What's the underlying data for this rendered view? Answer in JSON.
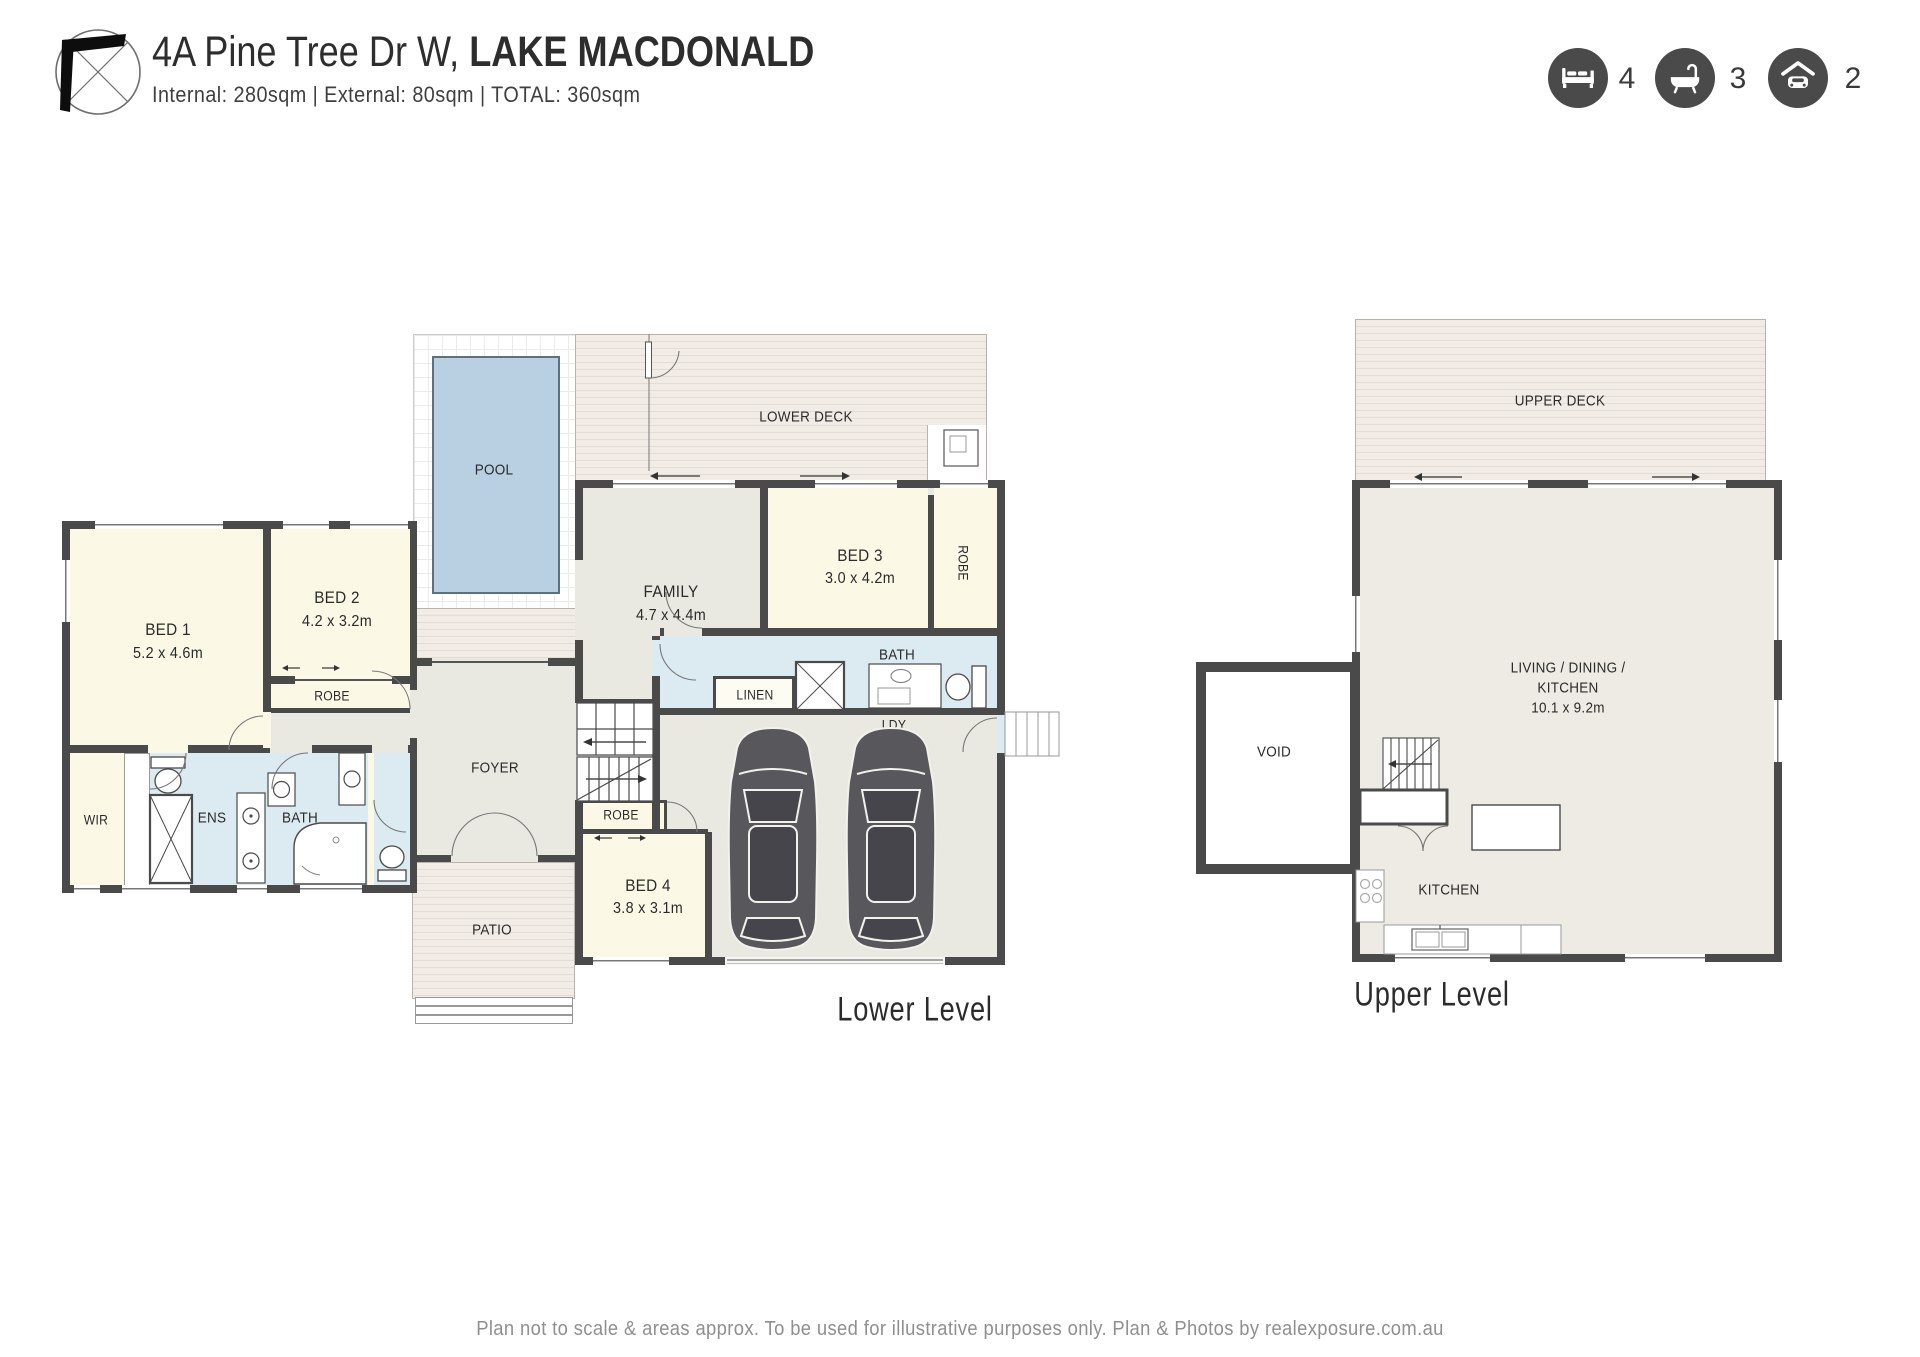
{
  "colors": {
    "wall": "#4a4a4b",
    "bedroom_fill": "#fbf9e6",
    "bath_fill": "#dcebf2",
    "interior_fill": "#e9e8e1",
    "deck_fill": "#f2ece7",
    "pool_fill": "#b9d0e2",
    "icon_circle": "#4a4a4b",
    "text": "#2b2b2b",
    "footer_text": "#8f8f8f"
  },
  "header": {
    "address_regular": "4A Pine Tree Dr W,",
    "address_bold": "LAKE MACDONALD",
    "area_line": "Internal: 280sqm  |  External: 80sqm  |  TOTAL: 360sqm",
    "features": [
      {
        "icon": "bed-icon",
        "count": "4"
      },
      {
        "icon": "bath-icon",
        "count": "3"
      },
      {
        "icon": "car-icon",
        "count": "2"
      }
    ]
  },
  "lower_level": {
    "title": "Lower Level",
    "labels": {
      "pool": "POOL",
      "lower_deck": "LOWER DECK",
      "bed1_name": "BED 1",
      "bed1_dim": "5.2 x 4.6m",
      "bed2_name": "BED 2",
      "bed2_dim": "4.2 x 3.2m",
      "bed3_name": "BED 3",
      "bed3_dim": "3.0 x 4.2m",
      "bed4_name": "BED 4",
      "bed4_dim": "3.8 x 3.1m",
      "robe_bed2": "ROBE",
      "robe_bed3": "ROBE",
      "robe_stairs": "ROBE",
      "wir": "WIR",
      "ens": "ENS",
      "bath_main": "BATH",
      "bath_upper": "BATH",
      "family_name": "FAMILY",
      "family_dim": "4.7 x 4.4m",
      "foyer": "FOYER",
      "patio": "PATIO",
      "linen": "LINEN",
      "ldy": "LDY"
    }
  },
  "upper_level": {
    "title": "Upper Level",
    "labels": {
      "upper_deck": "UPPER DECK",
      "living_line1": "LIVING / DINING /",
      "living_line2": "KITCHEN",
      "living_dim": "10.1 x 9.2m",
      "void": "VOID",
      "kitchen": "KITCHEN",
      "fridge": "F"
    }
  },
  "footer": "Plan not to scale & areas approx. To be used for illustrative purposes only. Plan & Photos by realexposure.com.au"
}
